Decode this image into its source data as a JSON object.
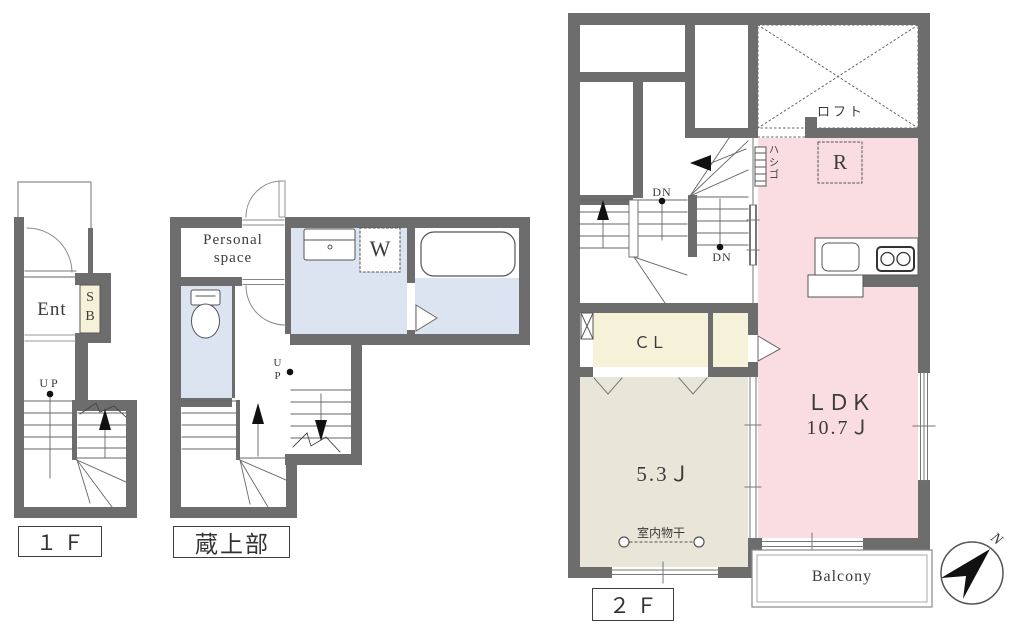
{
  "floor1": {
    "label": "１Ｆ",
    "entrance": "Ent",
    "shoe_box": "SB",
    "up": "UP"
  },
  "kura": {
    "label": "蔵上部",
    "personal_space": "Personal space",
    "washer": "W",
    "up": "UP"
  },
  "floor2": {
    "label": "２Ｆ",
    "loft": "ロフト",
    "loft_room": "R",
    "ladder": "ハシゴ",
    "down_a": "DN",
    "down_b": "DN",
    "closet": "ＣＬ",
    "ldk": "ＬＤＫ",
    "ldk_size": "10.7Ｊ",
    "room_size": "5.3Ｊ",
    "indoor_drying": "室内物干",
    "balcony": "Balcony"
  },
  "compass": {
    "north": "N"
  },
  "colors": {
    "wall": "#6d6d6d",
    "water_blue": "#dde4f1",
    "ldk_pink": "#fadde1",
    "room_beige": "#e9e5d8",
    "closet_cream": "#f6f2d9",
    "line": "#666666"
  }
}
